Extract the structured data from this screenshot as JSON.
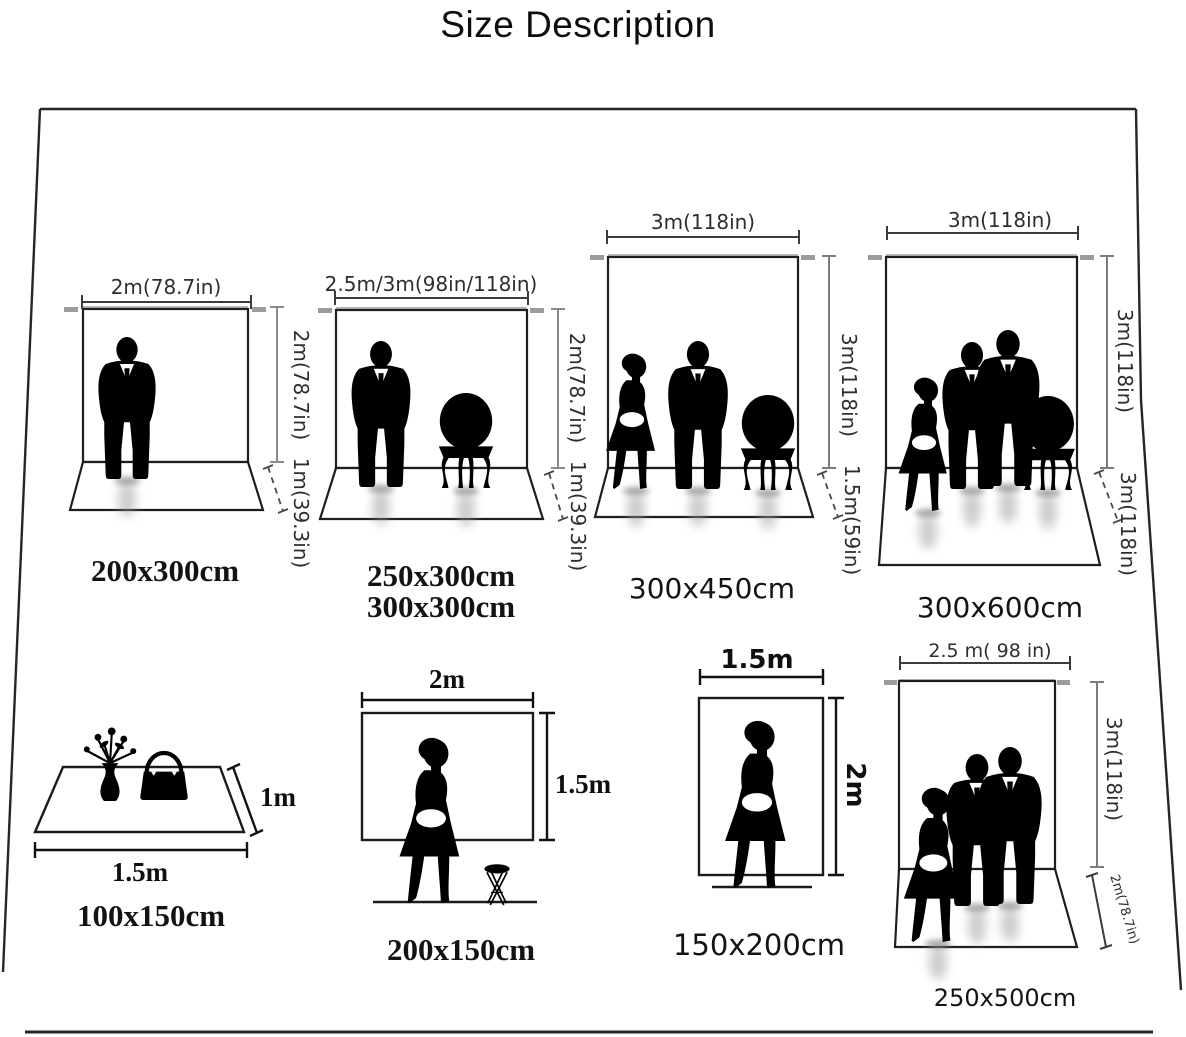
{
  "title": "Size Description",
  "diagrams": [
    {
      "caption": "200x300cm",
      "width_label": "2m(78.7in)",
      "height_label": "2m(78.7in)",
      "floor_label": "1m(39.3in)"
    },
    {
      "caption": "250x300cm",
      "caption2": "300x300cm",
      "width_label": "2.5m/3m(98in/118in)",
      "height_label": "2m(78.7in)",
      "floor_label": "1m(39.3in)"
    },
    {
      "caption": "300x450cm",
      "width_label": "3m(118in)",
      "height_label": "3m(118in)",
      "floor_label": "1.5m(59in)"
    },
    {
      "caption": "300x600cm",
      "width_label": "3m(118in)",
      "height_label": "3m(118in)",
      "floor_label": "3m(118in)"
    },
    {
      "caption": "100x150cm",
      "width_label": "1.5m",
      "height_label": "1m"
    },
    {
      "caption": "200x150cm",
      "width_label": "2m",
      "height_label": "1.5m"
    },
    {
      "caption": "150x200cm",
      "width_label": "1.5m",
      "height_label": "2m"
    },
    {
      "caption": "250x500cm",
      "width_label": "2.5 m( 98 in)",
      "height_label": "3m(118in)",
      "floor_label": "2m(78.7in)"
    }
  ]
}
